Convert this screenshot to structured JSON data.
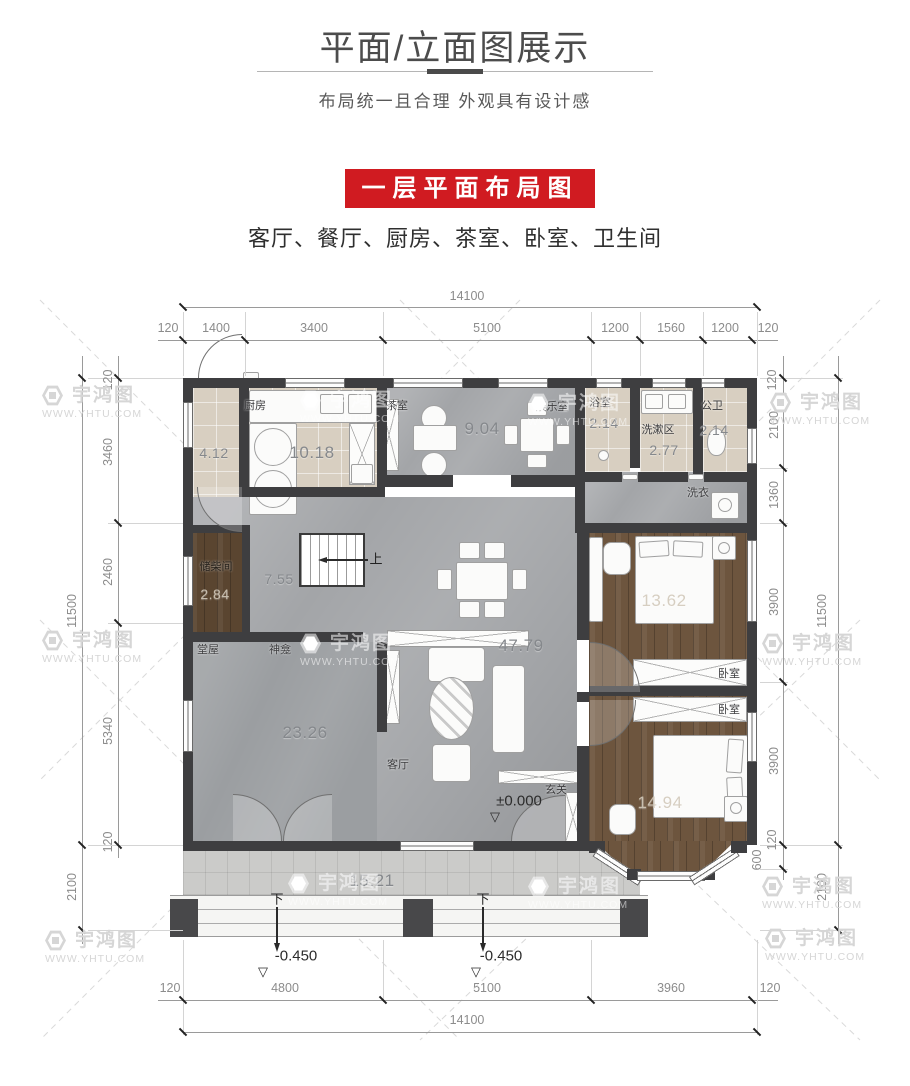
{
  "header": {
    "title": "平面/立面图展示",
    "subtitle": "布局统一且合理  外观具有设计感",
    "banner_label": "一层平面布局图",
    "rooms_line": "客厅、餐厅、厨房、茶室、卧室、卫生间"
  },
  "colors": {
    "banner_red": "#d01b21",
    "wall_dark": "#3e3e40",
    "floor_gray": "#a3a5a8",
    "floor_beige": "#d8cfc1",
    "floor_wood": "#6d553e",
    "dim_text": "#8c8c8c"
  },
  "watermark": {
    "brand": "宇鸿图",
    "url": "WWW.YHTU.COM"
  },
  "symbols": {
    "level_triangle": "▽"
  },
  "plan": {
    "labels": {
      "pantry_area": "4.12",
      "kitchen_name": "厨房",
      "kitchen_area": "10.18",
      "tea_name": "茶室",
      "tea_area": "9.04",
      "entertainment_name": "娱乐室",
      "bath_name": "浴室",
      "bath_area": "2.14",
      "wash_name": "洗漱区",
      "wash_area": "2.77",
      "wc_name": "公卫",
      "wc_area": "2.14",
      "laundry_name": "洗衣",
      "storage_name": "储柴间",
      "storage_area": "2.84",
      "hall_area": "7.55",
      "stair_up": "上",
      "main_hall_name": "堂屋",
      "shrine_name": "神龛",
      "main_hall_area": "23.26",
      "living_name": "客厅",
      "living_area": "47.79",
      "foyer_name": "玄关",
      "foyer_level": "±0.000",
      "bedroom1_name": "卧室",
      "bedroom1_area": "13.62",
      "bedroom2_name": "卧室",
      "bedroom2_area": "14.94",
      "porch_area": "15.21",
      "down_left": "下",
      "down_right": "下",
      "porch_level_left": "-0.450",
      "porch_level_right": "-0.450"
    },
    "dims": {
      "top_total": "14100",
      "top": [
        "120",
        "1400",
        "3400",
        "5100",
        "1200",
        "1560",
        "1200",
        "120"
      ],
      "left_outer_main": "11500",
      "left_outer_porch": "2100",
      "left": [
        "120",
        "3460",
        "2460",
        "5340",
        "120"
      ],
      "right_outer_main": "11500",
      "right_outer_porch": "2100",
      "right": [
        "120",
        "2100",
        "1360",
        "3900",
        "3900",
        "120",
        "600"
      ],
      "bottom": [
        "120",
        "4800",
        "5100",
        "3960",
        "120"
      ],
      "bottom_total": "14100"
    }
  }
}
